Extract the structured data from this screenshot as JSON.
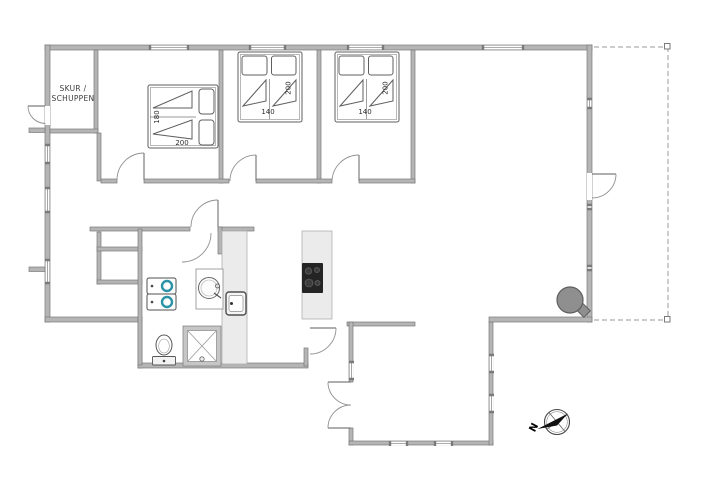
{
  "plan": {
    "room_labels": {
      "schuppen_line1": "SKUR /",
      "schuppen_line2": "SCHUPPEN"
    },
    "dimensions": {
      "bed1_width": "180",
      "bed1_length": "200",
      "bed2_width": "140",
      "bed2_length": "200",
      "bed3_width": "140",
      "bed3_length": "200"
    },
    "compass": {
      "north_label": "N"
    },
    "colors": {
      "wall_fill": "#b5b5b5",
      "wall_edge": "#7a7a7a",
      "counter_fill": "#ebebeb",
      "counter_edge": "#b0b0b0",
      "fixture_line": "#5f5f5f",
      "door_arc": "#909090",
      "appliance_accent": "#2a93a5",
      "cooktop": "#242424",
      "stove_fill": "#8f8f8f",
      "label_text": "#3c3c3c",
      "terrace_dash": "#9a9a9a",
      "needle": "#111111"
    }
  }
}
